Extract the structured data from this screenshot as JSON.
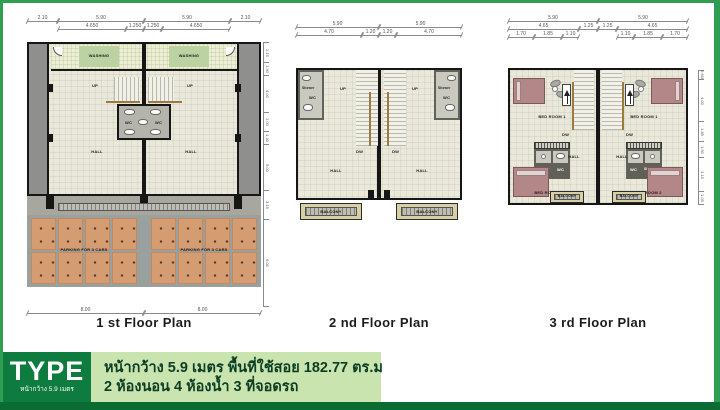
{
  "banner": {
    "type_label": "TYPE",
    "type_sublabel": "หน้ากว้าง 5.9 เมตร",
    "spec_line1": "หน้ากว้าง 5.9 เมตร พื้นที่ใช้สอย  182.77 ตร.ม",
    "spec_line2": "2 ห้องนอน  4 ห้องน้ำ  3  ที่จอดรถ"
  },
  "colors": {
    "frame_green": "#2f9e52",
    "bottom_bar_green": "#0a6b33",
    "type_box_green": "#0e7c3f",
    "spec_box_green": "#c9e4af",
    "parking_tile_orange": "#d59c72",
    "bed_mauve": "#b38787",
    "floor_cream": "#e9e8d9"
  },
  "plan1": {
    "caption": "1 st Floor Plan",
    "dims_row1": [
      "2.10",
      "5.90",
      "5.90",
      "2.10"
    ],
    "dims_row2": [
      "4.650",
      "1.250",
      "1.250",
      "4.650"
    ],
    "dims_bottom": [
      "8.00",
      "8.00"
    ],
    "dims_right": [
      "2.15",
      "1.40",
      "4.00",
      "2.00",
      "1.40",
      "5.00",
      "3.15",
      "6.00"
    ],
    "labels": {
      "washing": "WASHING",
      "up": "UP",
      "wc": "WC",
      "hall": "HALL",
      "parking": "PARKING FOR 3 CARS"
    }
  },
  "plan2": {
    "caption": "2 nd Floor Plan",
    "dims_row1": [
      "5.90",
      "5.90"
    ],
    "dims_row2": [
      "4.70",
      "1.20",
      "1.20",
      "4.70"
    ],
    "labels": {
      "up": "UP",
      "dw": "DW",
      "wc": "WC",
      "shower": "Shower",
      "hall": "HALL",
      "balcony": "BALCONY"
    }
  },
  "plan3": {
    "caption": "3 rd Floor Plan",
    "dims_row1": [
      "5.90",
      "5.90"
    ],
    "dims_row2": [
      "4.65",
      "1.25",
      "1.25",
      "4.65"
    ],
    "dims_row3_left": [
      "1.70",
      "1.85",
      "1.10"
    ],
    "dims_row3_right": [
      "1.10",
      "1.85",
      "1.70"
    ],
    "dims_right": [
      "0.665",
      "4.00",
      "1.85",
      "1.50",
      "3.15",
      "1.05"
    ],
    "labels": {
      "bedroom1": "BED ROOM 1",
      "bedroom2": "BED ROOM 2",
      "wc": "WC",
      "shower": "Shower",
      "hall": "HALL",
      "dw": "DW",
      "balcony": "BALCONY"
    }
  }
}
